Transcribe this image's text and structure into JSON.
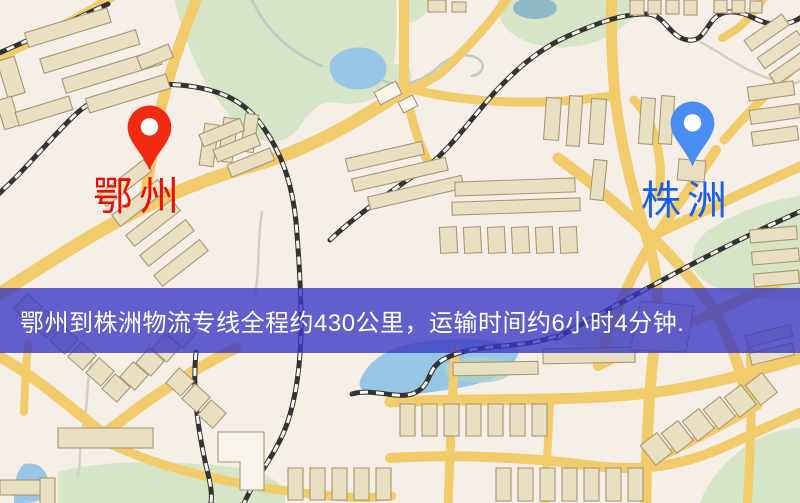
{
  "banner": {
    "text": "鄂州到株洲物流专线全程约430公里，运输时间约6小时4分钟.",
    "background_color": "#3835c3",
    "text_color": "#ffffff"
  },
  "markers": {
    "origin": {
      "label": "鄂州",
      "pin_color": "#f22a12",
      "label_color": "#e80f05"
    },
    "destination": {
      "label": "株洲",
      "pin_color": "#4a8df2",
      "label_color": "#1b5fe8"
    }
  },
  "route_info": {
    "distance_text": "约430公里",
    "duration_text": "约6小时4分钟"
  },
  "map_colors": {
    "background": "#f5efe8",
    "road": "#f2cc6b",
    "park": "#d6e5c5",
    "water": "#98c6e6",
    "building": "#e9dfc1",
    "railway": "#333333"
  }
}
